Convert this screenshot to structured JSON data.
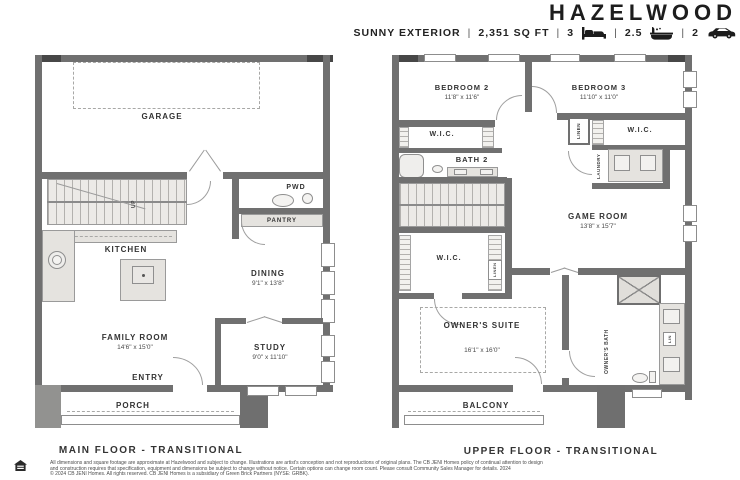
{
  "header": {
    "title": "HAZELWOOD",
    "exterior_label": "SUNNY EXTERIOR",
    "divider": "|",
    "sqft": "2,351 SQ FT",
    "beds": "3",
    "baths": "2.5",
    "garage_count": "2",
    "icons": [
      "bed-icon",
      "bath-icon",
      "car-icon"
    ]
  },
  "main_floor": {
    "caption": "MAIN FLOOR - TRANSITIONAL",
    "rooms": {
      "garage": "GARAGE",
      "kitchen": "KITCHEN",
      "pwd": "PWD",
      "pantry": "PANTRY",
      "dining": "DINING",
      "dining_dims": "9'1\" x 13'8\"",
      "family_room": "FAMILY ROOM",
      "family_room_dims": "14'6\" x 15'0\"",
      "study": "STUDY",
      "study_dims": "9'0\" x 11'10\"",
      "entry": "ENTRY",
      "porch": "PORCH",
      "stair_label": "UP"
    }
  },
  "upper_floor": {
    "caption": "UPPER FLOOR - TRANSITIONAL",
    "rooms": {
      "bedroom2": "BEDROOM 2",
      "bedroom2_dims": "11'8\" x 11'6\"",
      "bedroom3": "BEDROOM 3",
      "bedroom3_dims": "11'10\" x 11'0\"",
      "wic": "W.I.C.",
      "bath2": "BATH 2",
      "linen": "LINEN",
      "laundry": "LAUNDRY",
      "game_room": "GAME ROOM",
      "game_room_dims": "13'8\" x 15'7\"",
      "owners_suite": "OWNER'S SUITE",
      "owners_suite_dims": "16'1\" x 16'0\"",
      "owners_bath": "OWNER'S BATH",
      "lin": "LIN",
      "balcony": "BALCONY"
    }
  },
  "footer": {
    "disclaimer_line1": "All dimensions and square footage are approximate at Hazelwood and subject to change. Illustrations are artist's conception and not reproductions of original plans. The CB JENI Homes policy of continual attention to design",
    "disclaimer_line2": "and construction requires that specification, equipment and dimensions be subject to change without notice. Certain options can change room count. Please consult Community Sales Manager for details. 2024",
    "disclaimer_line3": "© 2024 CB JENI Homes. All rights reserved. CB JENI Homes is a subsidiary of Green Brick Partners (NYSE: GRBK)."
  },
  "colors": {
    "wall": "#707070",
    "wall_dark": "#474747",
    "fixture_fill": "#e5e3df",
    "text": "#2e2e2e"
  }
}
